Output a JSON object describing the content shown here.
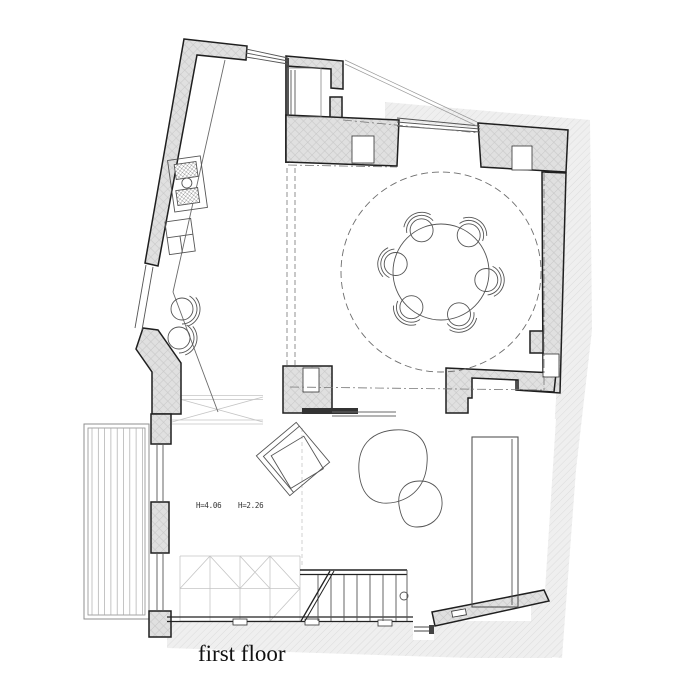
{
  "labels": {
    "floor_title": "first floor",
    "height_left": "H=4.06",
    "height_right": "H=2.26"
  },
  "colors": {
    "background": "#ffffff",
    "outline": "#1f1f1f",
    "wall_fill": "#e0e0e0",
    "wall_hatch_line": "#c7c7c7",
    "context_fill": "#efefef",
    "context_hatch_line": "#dcdcdc",
    "furniture_line": "#555555",
    "faint_line": "#c5c5c5",
    "dash_line": "#777777",
    "text": "#222222"
  }
}
